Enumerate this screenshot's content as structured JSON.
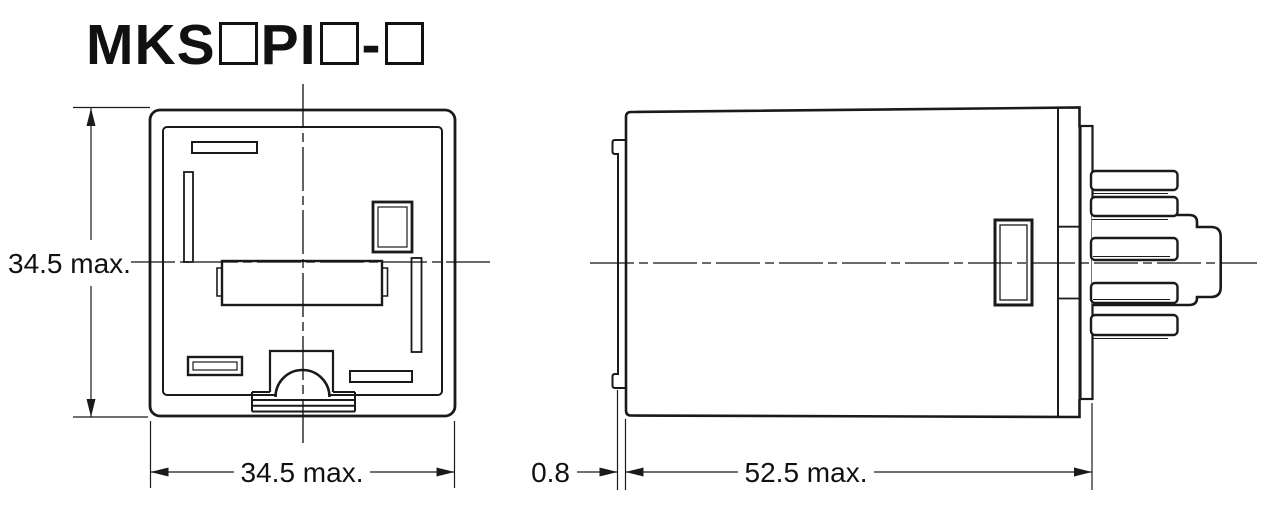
{
  "drawing": {
    "title": {
      "part1": "MKS",
      "part2": "PI",
      "part3": "-"
    },
    "dimensions": {
      "front_height": "34.5 max.",
      "front_width": "34.5 max.",
      "flange_thickness": "0.8",
      "body_depth": "52.5 max."
    },
    "colors": {
      "line": "#1a1a1a",
      "background": "#ffffff"
    }
  }
}
